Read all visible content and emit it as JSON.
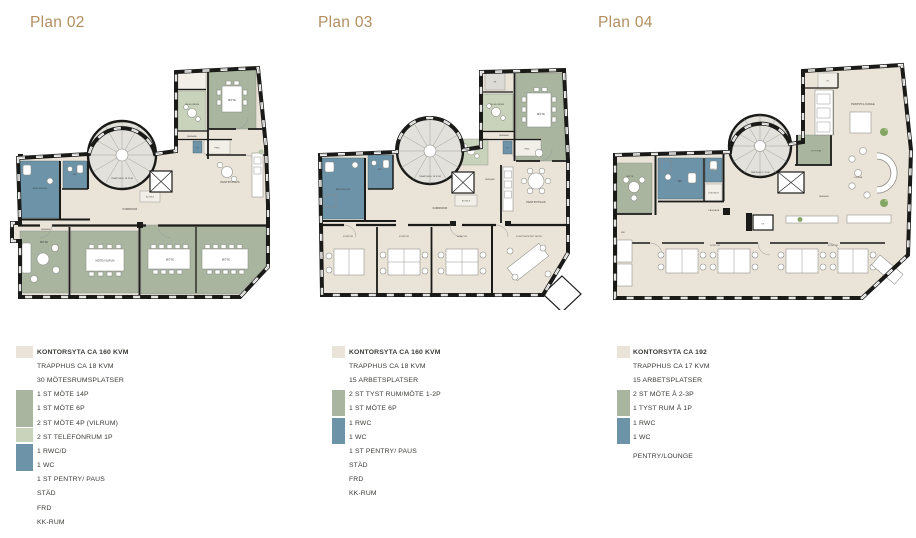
{
  "colors": {
    "office": "#eae3d8",
    "meeting": "#a9b59f",
    "phone": "#c9d2bb",
    "wet": "#6d93a8",
    "stair": "#e2e1dc",
    "wall": "#1a1a18",
    "title": "#b28e60"
  },
  "plans": [
    {
      "title": "Plan 02",
      "labels": {
        "rwc": "RWC/DUSCH",
        "wc": "WC",
        "st": "ST",
        "frd": "FRD",
        "telefonrum_top": "TELEFONRUM",
        "passage_top": "PASSAGE",
        "mote_top": "MÖTE",
        "pentry": "PENTRY/PAUS",
        "trapphus": "TRAPPHUS 18 KVM",
        "eltele": "EL/TELE",
        "korridor": "KORRIDOR",
        "passage_left": "PASSAGE",
        "mote_bl": "MÖTE",
        "mote_vilrum": "MÖTE/VILRUM",
        "mote_br1": "MÖTE",
        "mote_br2": "MÖTE"
      },
      "legend": [
        "KONTORSYTA CA 160 KVM",
        "TRAPPHUS CA 18 KVM",
        "30 MÖTESRUMSPLATSER",
        "1 ST MÖTE 14P",
        "1 ST MÖTE 6P",
        "2 ST MÖTE 4P (VILRUM)",
        "2 ST TELEFONRUM 1P",
        "1 RWC/D",
        "1 WC",
        "1 ST PENTRY/ PAUS",
        "STÄD",
        "FRD",
        "KK-RUM"
      ]
    },
    {
      "title": "Plan 03",
      "labels": {
        "kk": "KK",
        "telefonrum_top": "TELEFONRUM",
        "passage_top": "PASSAGE",
        "mote_top": "MÖTE",
        "frd": "FRD",
        "st": "ST",
        "telefonrum_mid": "TELEFONRUM",
        "rwc": "RWC/DUSCH",
        "wc": "WC",
        "trapphus": "TRAPPHUS 18 KVM",
        "eltele": "EL/TELE",
        "passage_mid": "PASSAGE",
        "korridor": "KORRIDOR",
        "pentry": "PENTRY/PAUS",
        "kontor1": "KONTOR",
        "kontor2": "KONTOR",
        "kontor3": "KONTOR",
        "kontor_oppet": "KONTOR/ÖPPET MÖTE"
      },
      "legend": [
        "KONTORSYTA CA 160 KVM",
        "TRAPPHUS CA 18 KVM",
        "15 ARBETSPLATSER",
        "2 ST TYST RUM/MÖTE 1-2P",
        "1 ST MÖTE 6P",
        "1 RWC",
        "1 WC",
        "1 ST PENTRY/ PAUS",
        "STÄD",
        "FRD",
        "KK-RUM"
      ]
    },
    {
      "title": "Plan 04",
      "labels": {
        "el": "EL",
        "pentry_lounge": "PENTRY/LOUNGE",
        "tyst_rum": "TYST RUM",
        "lounge": "LOUNGE",
        "passage_right": "PASSAGE",
        "trapphus": "TRAPPHUS 17 KVM",
        "kk": "KK",
        "wc": "WC",
        "rwc": "RWC",
        "dusch": "ST/DUSCH",
        "mote": "MÖTE",
        "frd": "FRD",
        "passage_left": "PASSAGE",
        "kontor1": "KONTOR",
        "kontor2": "KONTOR"
      },
      "legend": [
        "KONTORSYTA CA 192",
        "TRAPPHUS CA 17 KVM",
        "15 ARBETSPLATSER",
        "2 ST MÖTE Å 2-3P",
        "1 TYST RUM Å 1P",
        "1 RWC",
        "1 WC",
        "PENTRY/LOUNGE"
      ]
    }
  ]
}
